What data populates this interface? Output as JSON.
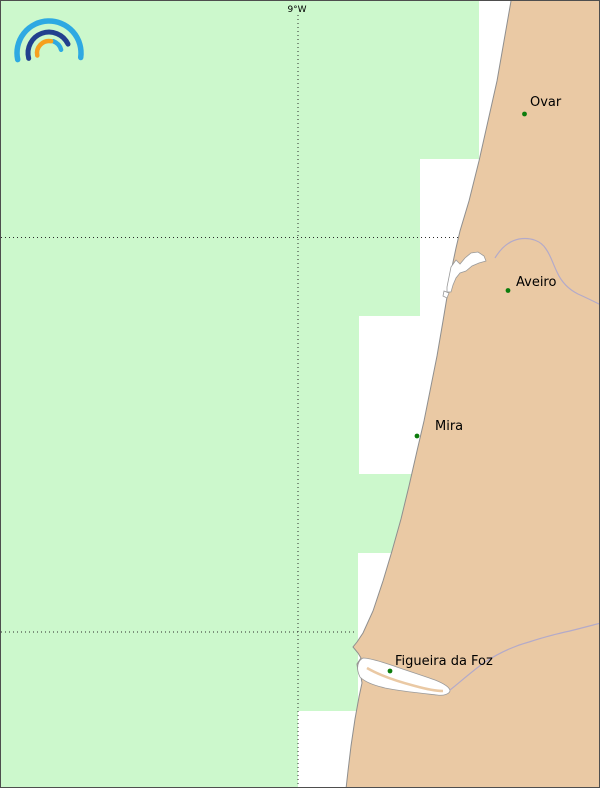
{
  "header": {
    "meridian_label": "9°W"
  },
  "logo": {
    "name": "ipma-rainbow-icon",
    "colors": {
      "outer_arc": "#2ea9e2",
      "middle_arc": "#22408e",
      "inner_arc": "#2ea9e2",
      "orange_arc": "#f6a01e"
    }
  },
  "map": {
    "colors": {
      "maritime_zone_green": "#ccf8cc",
      "sea_white": "#ffffff",
      "land_tan": "#eac9a4",
      "coastline_gray": "#8f8f8f",
      "river_purple": "#b3aac9",
      "gridline": "#2b2b2b",
      "city_dot_green": "#0c7c0c",
      "label_black": "#000000"
    },
    "cities": [
      {
        "name": "Ovar"
      },
      {
        "name": "Aveiro"
      },
      {
        "name": "Mira"
      },
      {
        "name": "Figueira da Foz"
      }
    ],
    "water_features": [
      {
        "name": "Ria de Aveiro lagoon"
      },
      {
        "name": "Mondego estuary"
      }
    ]
  }
}
